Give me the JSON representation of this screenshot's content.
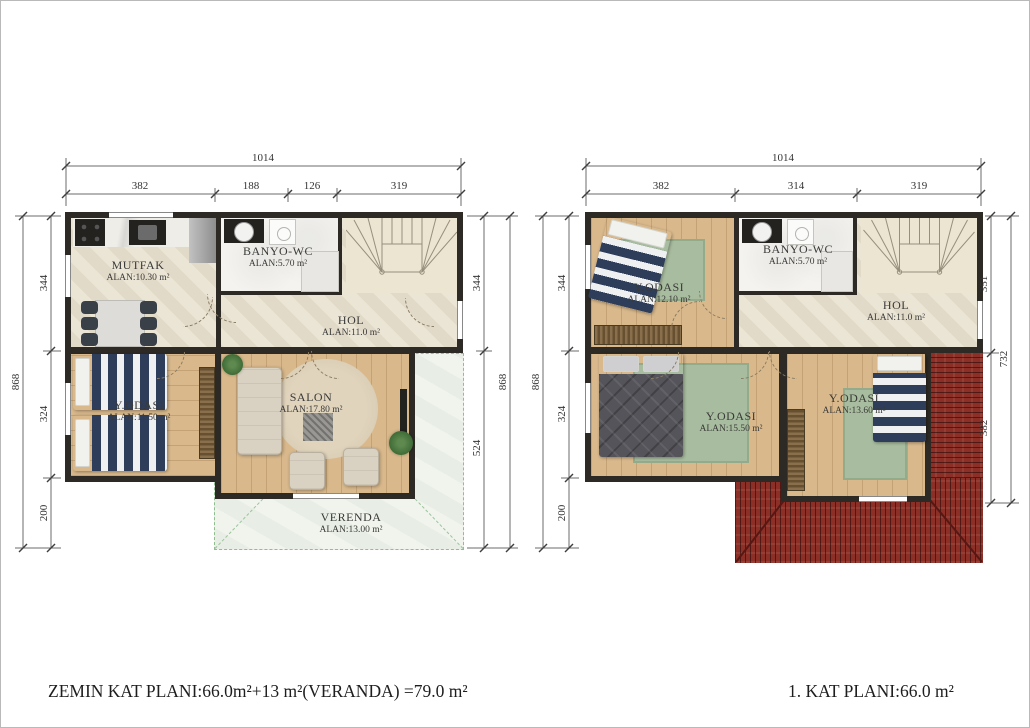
{
  "titles": {
    "left": "ZEMIN KAT PLANI:66.0m²+13 m²(VERANDA) =79.0 m²",
    "right": "1. KAT PLANI:66.0 m²"
  },
  "left_plan": {
    "dims": {
      "top_total": "1014",
      "top_segments": [
        "382",
        "188",
        "126",
        "319"
      ],
      "left_total": "868",
      "left_segments": [
        "344",
        "324",
        "200"
      ],
      "right_segments": [
        "344",
        "524"
      ],
      "right_total": "868"
    },
    "rooms": {
      "mutfak": {
        "name": "MUTFAK",
        "area": "ALAN:10.30 m²"
      },
      "banyo": {
        "name": "BANYO-WC",
        "area": "ALAN:5.70 m²"
      },
      "hol": {
        "name": "HOL",
        "area": "ALAN:11.0 m²"
      },
      "yodasi": {
        "name": "Y.ODASI",
        "area": "ALAN:11.50 m²"
      },
      "salon": {
        "name": "SALON",
        "area": "ALAN:17.80 m²"
      },
      "veranda": {
        "name": "VERENDA",
        "area": "ALAN:13.00 m²"
      }
    }
  },
  "right_plan": {
    "dims": {
      "top_total": "1014",
      "top_segments": [
        "382",
        "314",
        "319"
      ],
      "left_total": "868",
      "left_segments": [
        "344",
        "324",
        "200"
      ],
      "right_segments": [
        "351",
        "382"
      ],
      "right_total": "732"
    },
    "rooms": {
      "yodasi1": {
        "name": "Y.ODASI",
        "area": "ALAN:12.10 m²"
      },
      "banyo": {
        "name": "BANYO-WC",
        "area": "ALAN:5.70 m²"
      },
      "hol": {
        "name": "HOL",
        "area": "ALAN:11.0 m²"
      },
      "yodasi2": {
        "name": "Y.ODASI",
        "area": "ALAN:15.50 m²"
      },
      "yodasi3": {
        "name": "Y.ODASI",
        "area": "ALAN:13.60 m²"
      }
    }
  },
  "colors": {
    "wall": "#2d2a25",
    "travertine_floor": "#eae3d3",
    "wood_floor": "#d9b98c",
    "bath_floor": "#f4f3f0",
    "rug_green": "#a8bd9f",
    "bed_navy": "#2e3d59",
    "roof_red": "#8c2f27",
    "veranda_green": "#8fbe8f",
    "dimension_line": "#555555"
  }
}
